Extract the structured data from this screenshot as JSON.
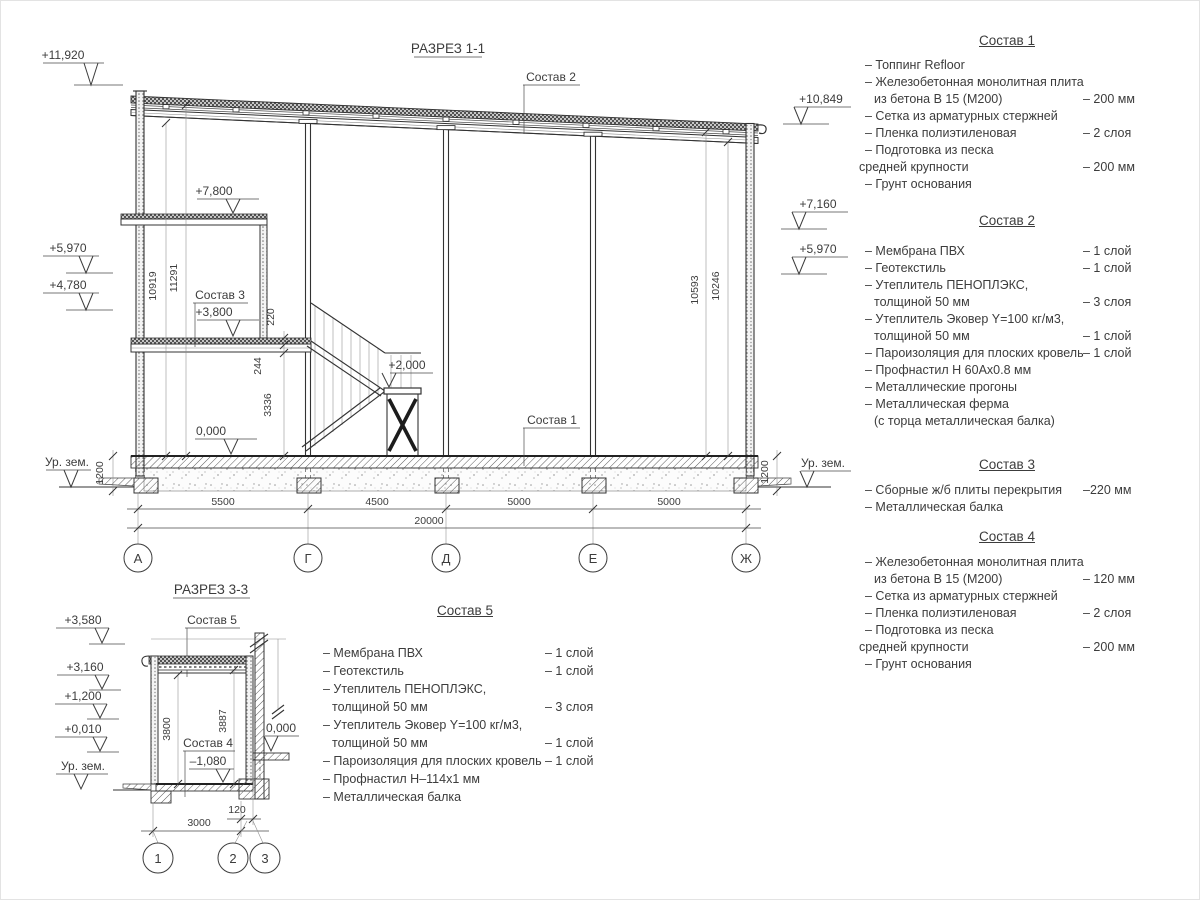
{
  "s11": {
    "title": "РАЗРЕЗ 1-1",
    "leader_sostav1": "Состав 1",
    "leader_sostav2": "Состав 2",
    "leader_sostav3": "Состав 3",
    "elev_11920": "+11,920",
    "elev_left_5970": "+5,970",
    "elev_left_4780": "+4,780",
    "elev_right_10849": "+10,849",
    "elev_right_7160": "+7,160",
    "elev_right_5970": "+5,970",
    "elev_7800": "+7,800",
    "elev_3800": "+3,800",
    "elev_2000": "+2,000",
    "elev_0000": "0,000",
    "ground_left": "Ур. зем.",
    "ground_right": "Ур. зем.",
    "dim_10919": "10919",
    "dim_11291": "11291",
    "dim_10593": "10593",
    "dim_10246": "10246",
    "dim_220": "220",
    "dim_244": "244",
    "dim_3336": "3336",
    "dim_1200_left": "1200",
    "dim_1200_right": "1200",
    "dim_5500": "5500",
    "dim_4500": "4500",
    "dim_5000a": "5000",
    "dim_5000b": "5000",
    "dim_20000": "20000",
    "axis_a": "А",
    "axis_g": "Г",
    "axis_d": "Д",
    "axis_e": "Е",
    "axis_zh": "Ж"
  },
  "s33": {
    "title": "РАЗРЕЗ 3-3",
    "leader_sostav5": "Состав 5",
    "leader_sostav4": "Состав 4",
    "elev_3580": "+3,580",
    "elev_3160": "+3,160",
    "elev_1200": "+1,200",
    "elev_0010": "+0,010",
    "elev_m1080": "–1,080",
    "elev_0000": "0,000",
    "ground": "Ур. зем.",
    "dim_3800": "3800",
    "dim_3887": "3887",
    "dim_120": "120",
    "dim_3000": "3000",
    "axis_1": "1",
    "axis_2": "2",
    "axis_3": "3"
  },
  "comp1": {
    "title": "Состав 1",
    "items": [
      {
        "t": "– Топпинг Refloor",
        "v": ""
      },
      {
        "t": "– Железобетонная монолитная плита",
        "v": ""
      },
      {
        "t": "из бетона В 15 (М200)",
        "v": "– 200 мм"
      },
      {
        "t": "– Сетка из арматурных стержней",
        "v": ""
      },
      {
        "t": "– Пленка полиэтиленовая",
        "v": "– 2 слоя"
      },
      {
        "t": "– Подготовка из песка",
        "v": ""
      },
      {
        "t": "средней крупности",
        "v": "– 200 мм"
      },
      {
        "t": "– Грунт основания",
        "v": ""
      }
    ]
  },
  "comp2": {
    "title": "Состав 2",
    "items": [
      {
        "t": "– Мембрана ПВХ",
        "v": "– 1 слой"
      },
      {
        "t": "– Геотекстиль",
        "v": "– 1 слой"
      },
      {
        "t": "– Утеплитель ПЕНОПЛЭКС,",
        "v": ""
      },
      {
        "t": "толщиной 50 мм",
        "v": "– 3 слоя"
      },
      {
        "t": "– Утеплитель Эковер Y=100 кг/м3,",
        "v": ""
      },
      {
        "t": "толщиной 50 мм",
        "v": "– 1 слой"
      },
      {
        "t": "– Пароизоляция для плоских кровель",
        "v": "– 1 слой"
      },
      {
        "t": "– Профнастил Н 60Ах0.8 мм",
        "v": ""
      },
      {
        "t": "– Металлические прогоны",
        "v": ""
      },
      {
        "t": "– Металлическая ферма",
        "v": ""
      },
      {
        "t": "(с торца металлическая балка)",
        "v": ""
      }
    ]
  },
  "comp3": {
    "title": "Состав 3",
    "items": [
      {
        "t": "– Сборные ж/б плиты перекрытия",
        "v": "–220 мм"
      },
      {
        "t": "– Металлическая балка",
        "v": ""
      }
    ]
  },
  "comp4": {
    "title": "Состав 4",
    "items": [
      {
        "t": "– Железобетонная монолитная плита",
        "v": ""
      },
      {
        "t": "из бетона В 15 (М200)",
        "v": "– 120 мм"
      },
      {
        "t": "– Сетка из арматурных стержней",
        "v": ""
      },
      {
        "t": "– Пленка полиэтиленовая",
        "v": "– 2 слоя"
      },
      {
        "t": "– Подготовка из песка",
        "v": ""
      },
      {
        "t": "средней крупности",
        "v": "– 200 мм"
      },
      {
        "t": "– Грунт основания",
        "v": ""
      }
    ]
  },
  "comp5": {
    "title": "Состав 5",
    "items": [
      {
        "t": "– Мембрана ПВХ",
        "v": "– 1 слой"
      },
      {
        "t": "– Геотекстиль",
        "v": "– 1 слой"
      },
      {
        "t": "– Утеплитель ПЕНОПЛЭКС,",
        "v": ""
      },
      {
        "t": "толщиной 50 мм",
        "v": "– 3 слоя"
      },
      {
        "t": "– Утеплитель Эковер Y=100 кг/м3,",
        "v": ""
      },
      {
        "t": "толщиной 50 мм",
        "v": "– 1 слой"
      },
      {
        "t": "– Пароизоляция для плоских кровель",
        "v": "– 1 слой"
      },
      {
        "t": "– Профнастил Н–114х1 мм",
        "v": ""
      },
      {
        "t": "– Металлическая балка",
        "v": ""
      }
    ]
  }
}
